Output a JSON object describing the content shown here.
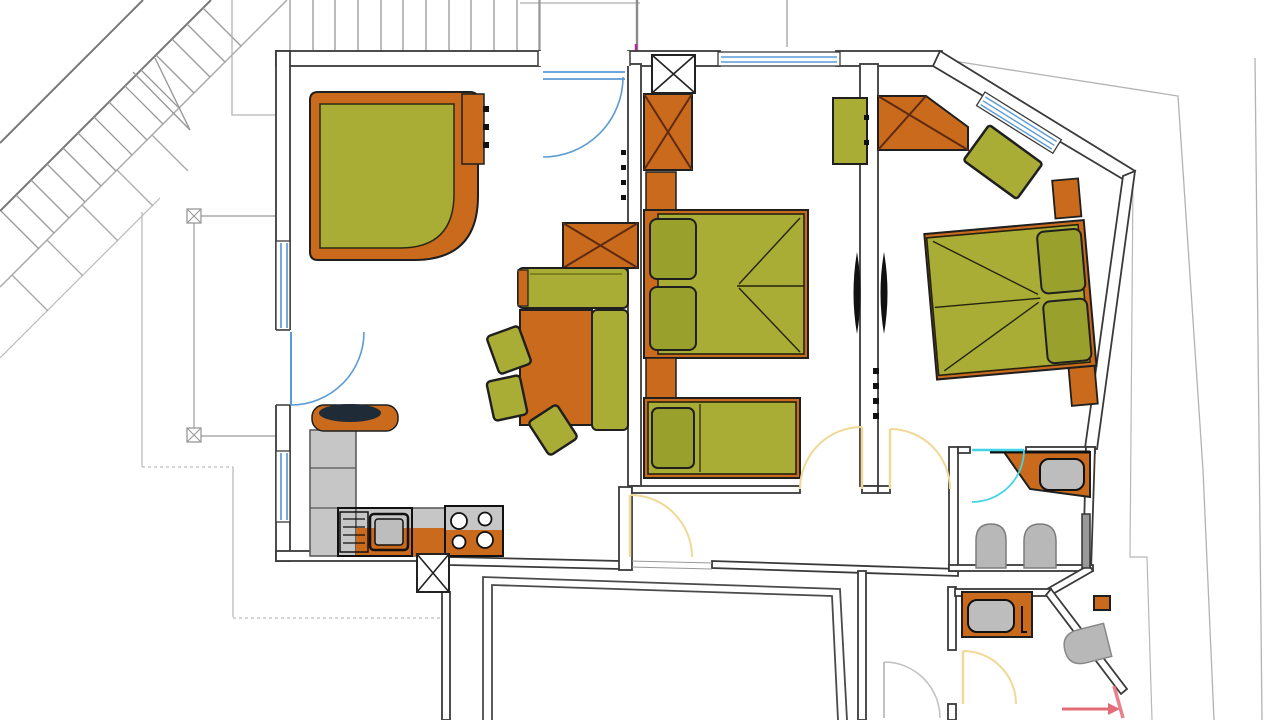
{
  "meta": {
    "title": "apartment-floor-plan",
    "width": 1280,
    "height": 720,
    "type": "architectural-floor-plan",
    "visible_text": "none"
  },
  "palette": {
    "wall": "#3a3a3a",
    "outline": "#1f1f1f",
    "olive": "#a9ac35",
    "oliveDeep": "#99a02c",
    "orange": "#c96a1d",
    "xline": "#5f2a10",
    "furnGray": "#bdbdbd",
    "applianceGray": "#c6c6c6",
    "blue": "#5b9bd5",
    "cyan": "#44d4e8",
    "yellow": "#f0d896",
    "doorGray": "#c2c2c2",
    "pink": "#e36b75",
    "boundary": "#b3b3b3",
    "stairGray": "#8f8f8f",
    "dark": "#111111",
    "navy": "#202b38",
    "white": "#ffffff"
  },
  "rooms": [
    "living-room-with-kitchen",
    "bedroom-1",
    "bedroom-2",
    "en-suite-bathroom",
    "wc",
    "hallway",
    "balcony",
    "exterior-staircase",
    "lower-room"
  ],
  "furniture": {
    "living_room": [
      "corner-sofa",
      "side-shelf",
      "crossed-cupboard",
      "dining-bench-top",
      "dining-bench-right",
      "dining-table",
      "chair",
      "chair",
      "chair",
      "coat-hooks"
    ],
    "kitchen": [
      "tall-cabinets",
      "round-counter-table",
      "worktop",
      "sink-with-drainer",
      "stove-4-burners",
      "crossed-duct-box"
    ],
    "bedroom_1": [
      "crossed-wardrobe",
      "double-bed-two-pillows",
      "nightstand",
      "wall-bench",
      "single-bed"
    ],
    "bedroom_2": [
      "crossed-wardrobe",
      "rotated-bench",
      "double-bed-two-pillows",
      "headboard-blocks",
      "wall-radiators"
    ],
    "bathroom": [
      "vanity-with-sink",
      "toilet",
      "bidet",
      "towel-radiator"
    ],
    "wc": [
      "vanity-with-sink",
      "toilet",
      "corner-duct"
    ]
  },
  "openings": {
    "entry_door_color": "#5b9bd5",
    "balcony_door_color": "#5b9bd5",
    "interior_door_color": "#f0d896",
    "bathroom_door_color": "#44d4e8",
    "exterior_lower_door_color": "#c2c2c2",
    "windows": [
      "left-wall-window-1",
      "left-wall-window-2",
      "bedroom1-top-window",
      "bedroom2-diagonal-window"
    ],
    "direction_arrow_color": "#e36b75"
  },
  "stairs": {
    "upper_flight_vertical_lines": 12,
    "diagonal_treads": 14,
    "lower_diagonal_treads": 5
  }
}
